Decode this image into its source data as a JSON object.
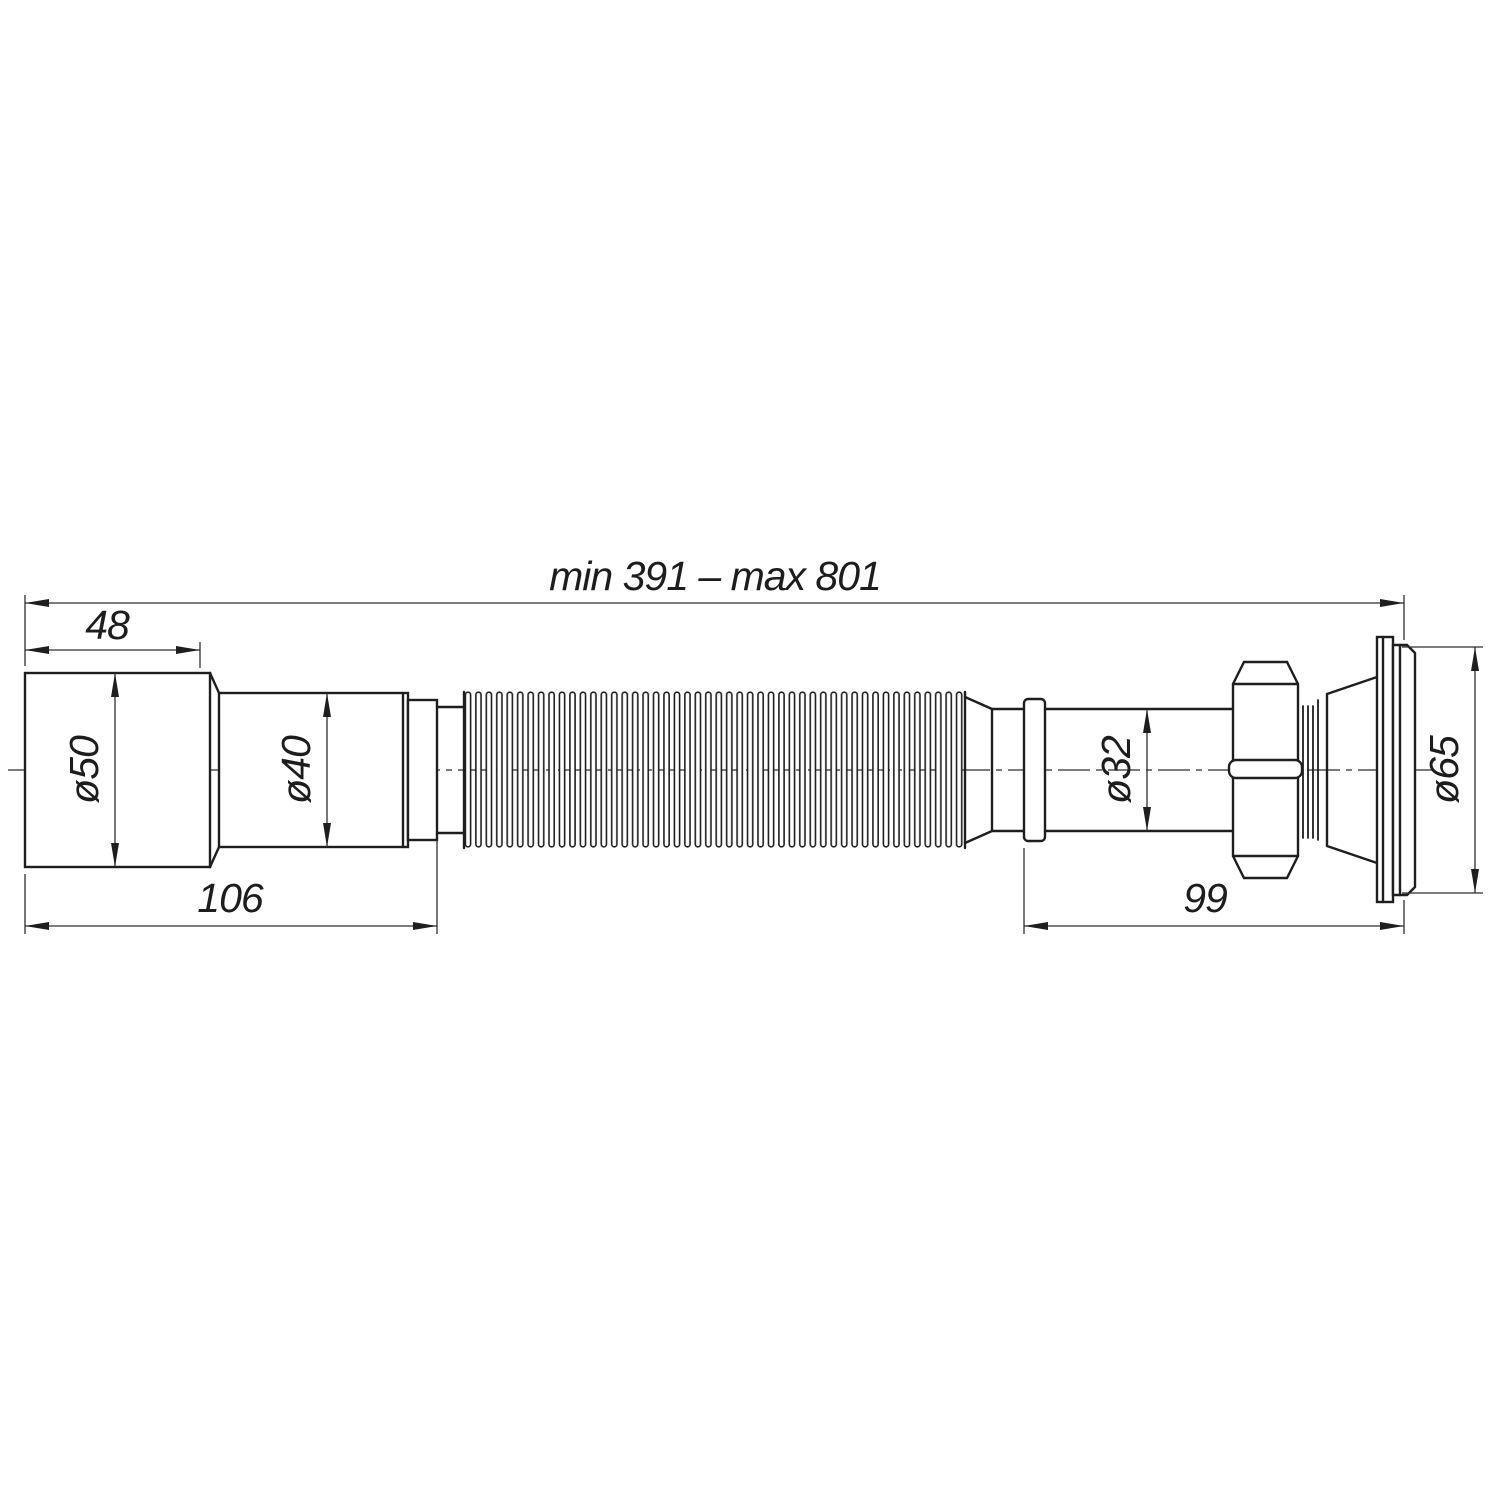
{
  "colors": {
    "background": "#ffffff",
    "contour": "#1e1e1e",
    "thin_line": "#2e2e2e"
  },
  "labels": {
    "overall": "min 391 – max 801",
    "len48": "48",
    "len106": "106",
    "len99": "99",
    "dia50": "ø50",
    "dia40": "ø40",
    "dia32": "ø32",
    "dia65": "ø65"
  }
}
